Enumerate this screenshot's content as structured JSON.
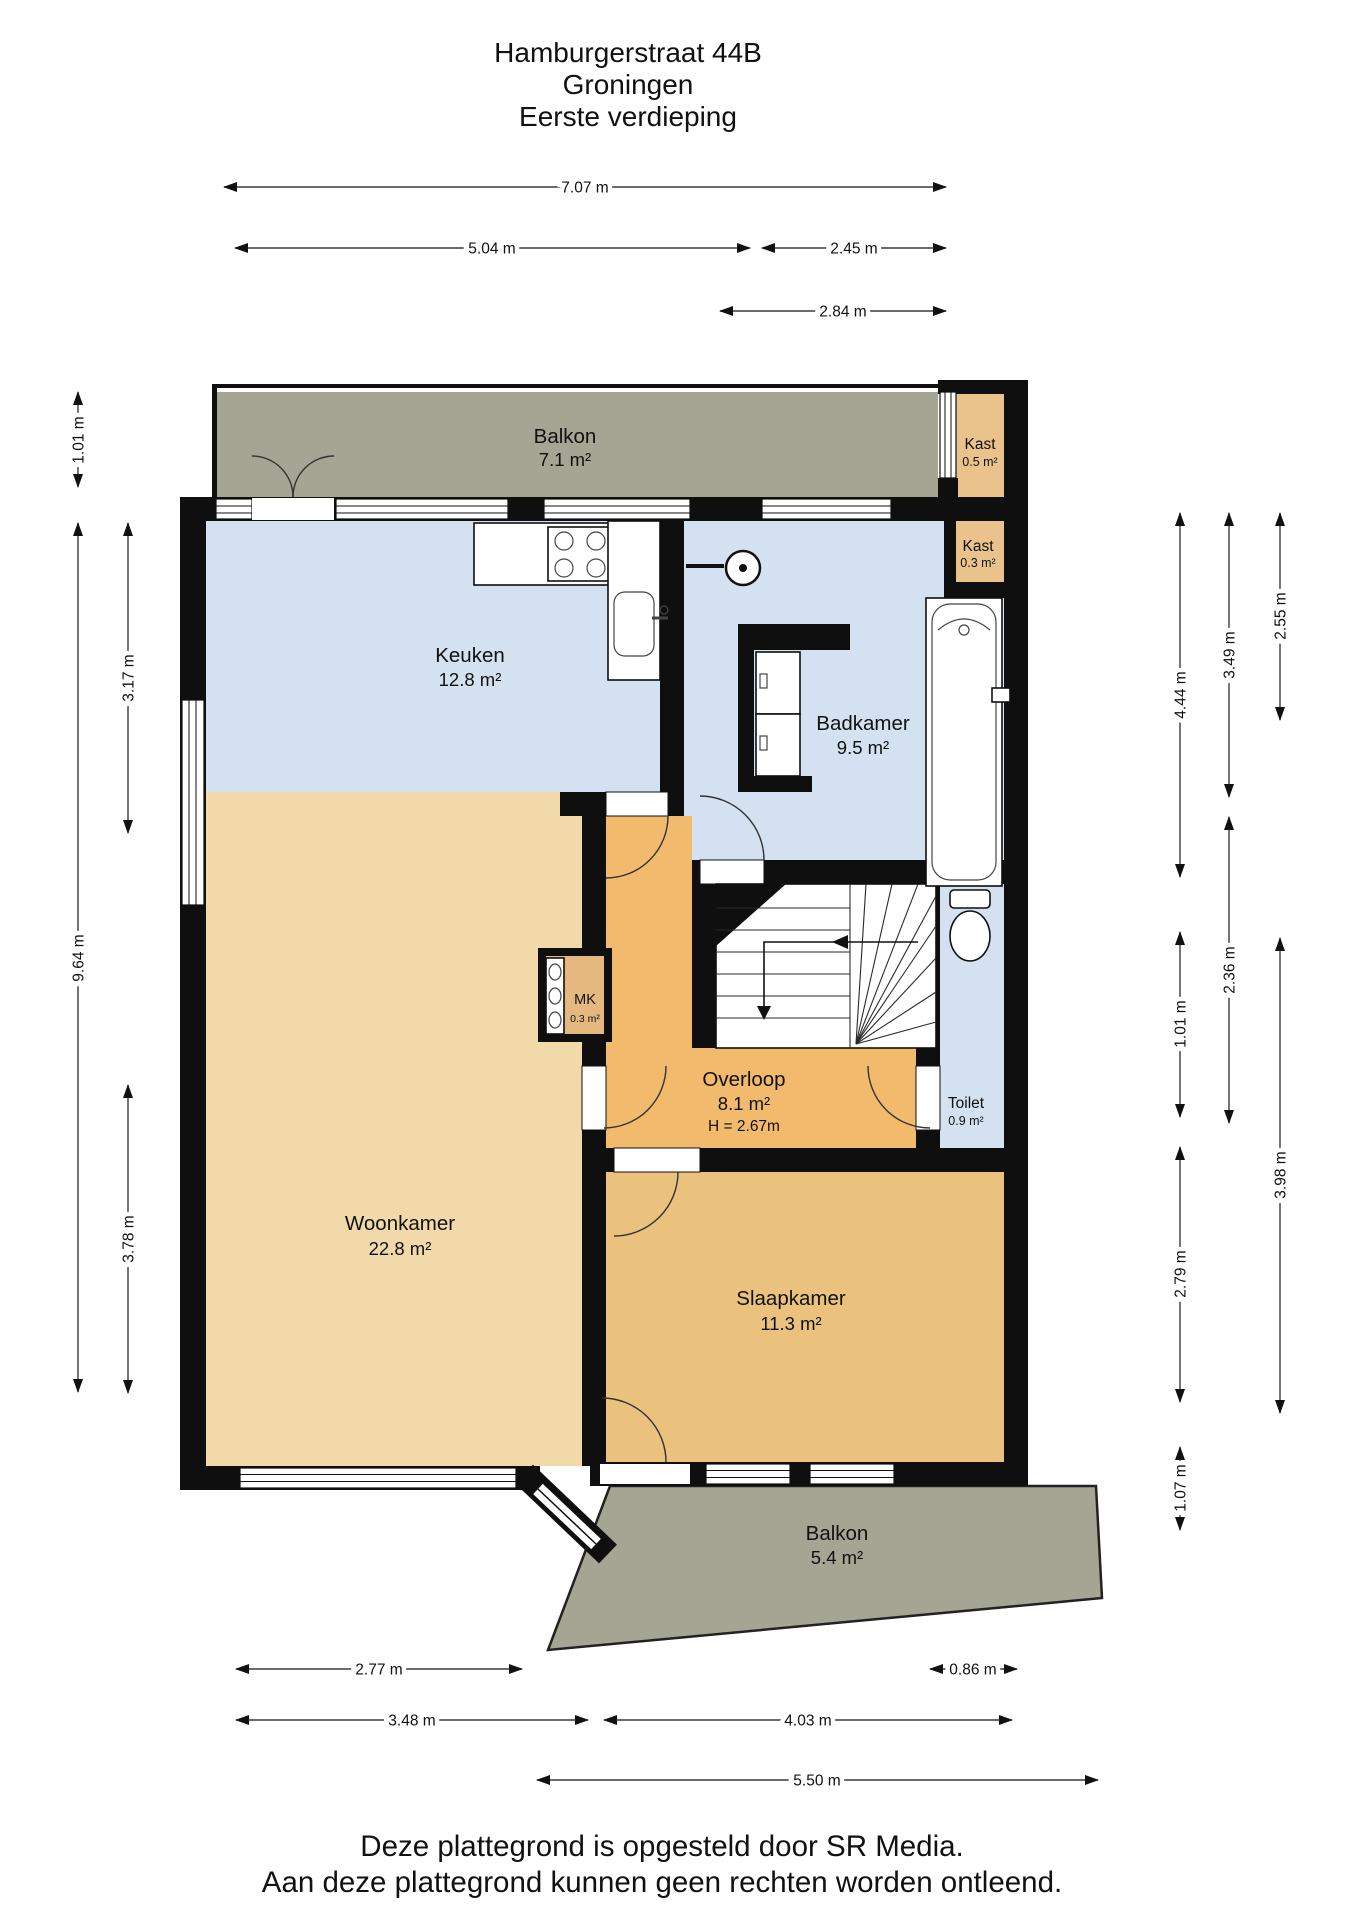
{
  "title": {
    "line1": "Hamburgerstraat 44B",
    "line2": "Groningen",
    "line3": "Eerste verdieping"
  },
  "rooms": {
    "balkon_top": {
      "name": "Balkon",
      "area": "7.1 m²"
    },
    "kast_top": {
      "name": "Kast",
      "area": "0.5 m²"
    },
    "keuken": {
      "name": "Keuken",
      "area": "12.8 m²"
    },
    "kast_right": {
      "name": "Kast",
      "area": "0.3 m²"
    },
    "badkamer": {
      "name": "Badkamer",
      "area": "9.5 m²"
    },
    "mk": {
      "name": "MK",
      "area": "0.3 m²"
    },
    "overloop": {
      "name": "Overloop",
      "area": "8.1 m²",
      "height": "H = 2.67m"
    },
    "toilet": {
      "name": "Toilet",
      "area": "0.9 m²"
    },
    "woonkamer": {
      "name": "Woonkamer",
      "area": "22.8 m²"
    },
    "slaapkamer": {
      "name": "Slaapkamer",
      "area": "11.3 m²"
    },
    "balkon_bottom": {
      "name": "Balkon",
      "area": "5.4 m²"
    }
  },
  "dims": {
    "t1": "7.07 m",
    "t2": "5.04 m",
    "t3": "2.45 m",
    "t4": "2.84 m",
    "b1": "2.77 m",
    "b2": "0.86 m",
    "b3": "3.48 m",
    "b4": "4.03 m",
    "b5": "5.50 m",
    "l1": "1.01 m",
    "l2": "9.64 m",
    "l3": "3.17 m",
    "l4": "3.78 m",
    "r1": "4.44 m",
    "r2": "1.01 m",
    "r3": "2.79 m",
    "r4": "1.07 m",
    "r5": "3.49 m",
    "r6": "2.36 m",
    "r7": "2.55 m",
    "r8": "3.98 m"
  },
  "footer": {
    "line1": "Deze plattegrond is opgesteld door SR Media.",
    "line2": "Aan deze plattegrond kunnen geen rechten worden ontleend."
  },
  "colors": {
    "wall": "#0f0f0f",
    "balkon": "#a4a592",
    "wet": "#d3e1f1",
    "woonkamer": "#f2d9a9",
    "overloop": "#f1ba6c",
    "slaapkamer": "#ebc17e",
    "kast": "#eac28b",
    "mk": "#e5b87f"
  }
}
